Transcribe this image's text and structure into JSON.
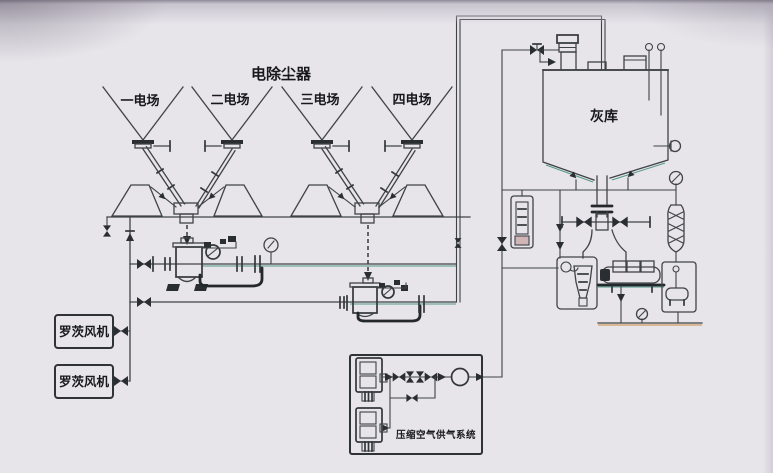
{
  "diagram": {
    "title": "电除尘器",
    "esp_fields": [
      {
        "label": "一电场"
      },
      {
        "label": "二电场"
      },
      {
        "label": "三电场"
      },
      {
        "label": "四电场"
      }
    ],
    "silo": {
      "label": "灰库"
    },
    "blowers": [
      {
        "label": "罗茨风机"
      },
      {
        "label": "罗茨风机"
      }
    ],
    "air_system": {
      "label": "压缩空气供气系统"
    },
    "icons": {
      "valve": "bowtie",
      "check_valve": "solid-triangle",
      "pressure_gauge": "circle-on-stem",
      "flow_arrow": "solid-right-triangle",
      "bag_filter": "stacked-rectangles",
      "telescopic_chute": "coil-capsule"
    },
    "colors": {
      "background": "#e7e4ea",
      "line": "#3f4347",
      "dark": "#24282c",
      "teal_fringe": "#55988a",
      "orange_fringe": "#cc8a3f",
      "text": "#17181a"
    }
  }
}
